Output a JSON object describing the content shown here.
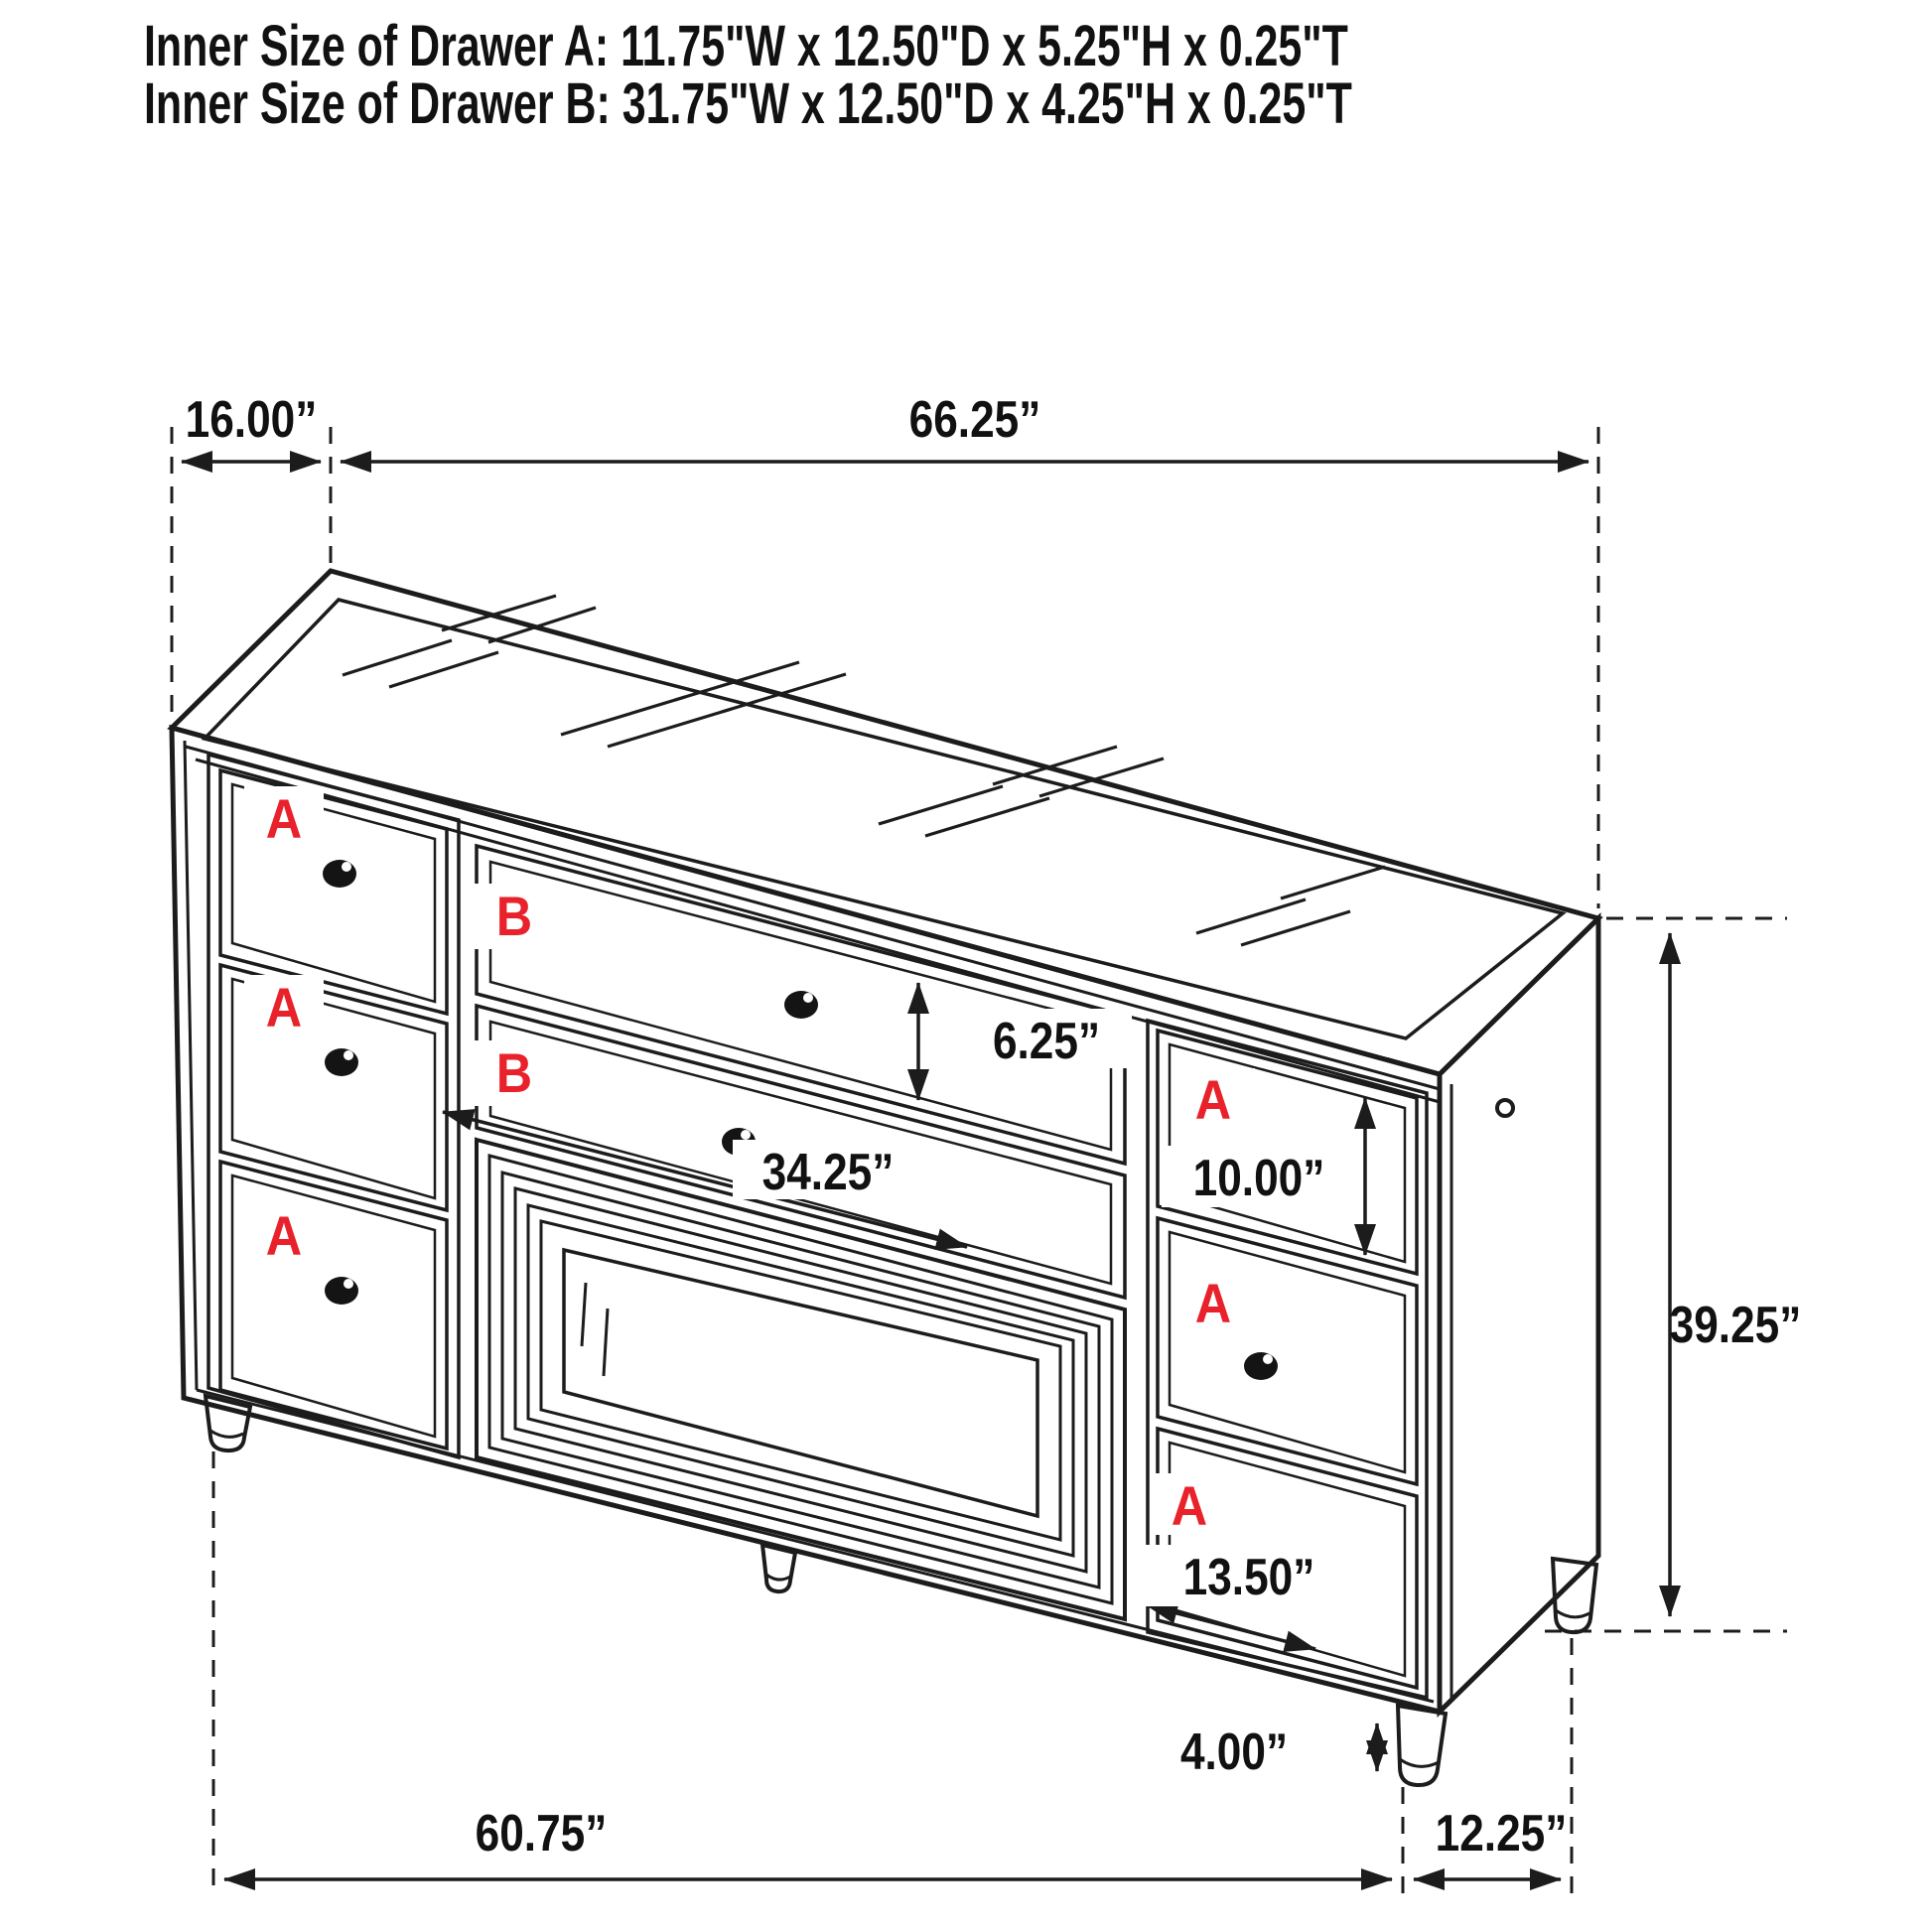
{
  "header": {
    "line1": "Inner Size of Drawer A: 11.75\"W x 12.50\"D x 5.25\"H x 0.25\"T",
    "line2": "Inner Size of Drawer B: 31.75\"W x 12.50\"D x 4.25\"H x 0.25\"T"
  },
  "dimensions": {
    "top_depth": "16.00”",
    "top_width": "66.25”",
    "b_drawer_height": "6.25”",
    "b_drawer_width": "34.25”",
    "right_top_drawer_height": "10.00”",
    "right_bottom_drawer_width": "13.50”",
    "overall_height": "39.25”",
    "leg_height": "4.00”",
    "base_width": "60.75”",
    "base_depth": "12.25”"
  },
  "drawer_labels": {
    "a": "A",
    "b": "B"
  },
  "colors": {
    "line": "#1c1c1c",
    "label_red": "#e8212b",
    "text": "#111111",
    "background": "#ffffff"
  }
}
